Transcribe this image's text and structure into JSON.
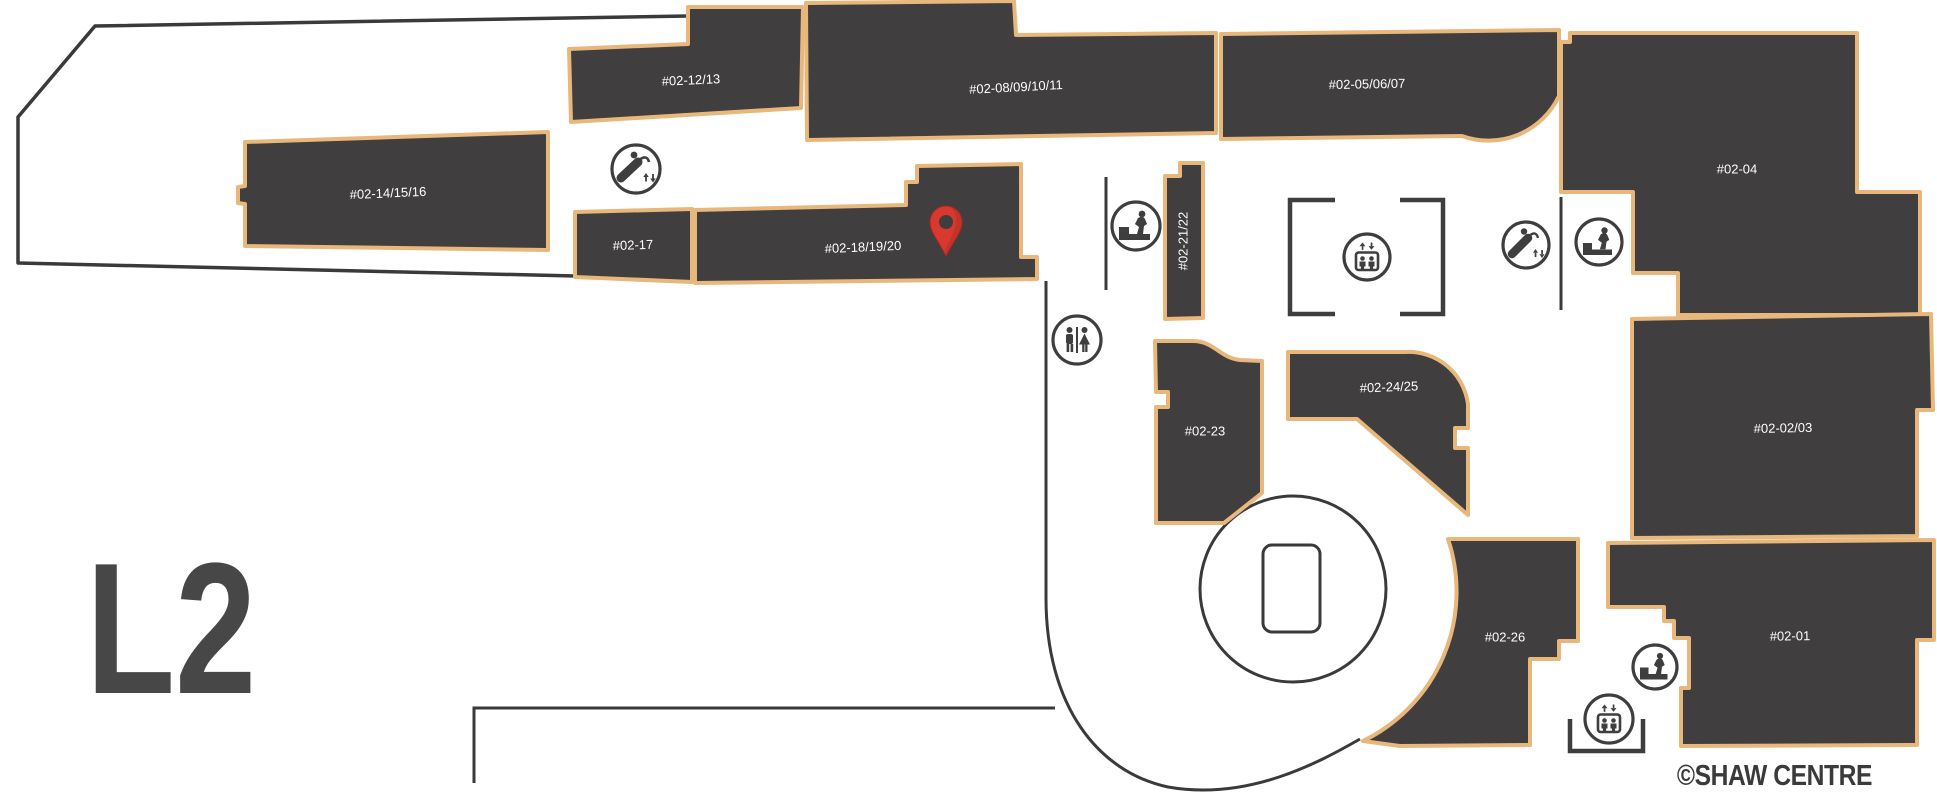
{
  "title": "Shaw Centre Floor Plan - Level 2",
  "floor_label": "L2",
  "copyright": "©SHAW CENTRE",
  "colors": {
    "background": "#FFFFFF",
    "unit_fill": "#403E3E",
    "unit_border": "#E8B77C",
    "outline": "#3A3A3A",
    "label_text": "#FFFFFF",
    "floor_text": "#474747",
    "pin_red": "#D8382E",
    "pin_red_dark": "#A5291F",
    "pin_hole": "#3F3E3E"
  },
  "units": [
    {
      "label": "#02-12/13"
    },
    {
      "label": "#02-08/09/10/11"
    },
    {
      "label": "#02-05/06/07"
    },
    {
      "label": "#02-04"
    },
    {
      "label": "#02-14/15/16"
    },
    {
      "label": "#02-17"
    },
    {
      "label": "#02-18/19/20"
    },
    {
      "label": "#02-21/22"
    },
    {
      "label": "#02-23"
    },
    {
      "label": "#02-24/25"
    },
    {
      "label": "#02-02/03"
    },
    {
      "label": "#02-26"
    },
    {
      "label": "#02-01"
    }
  ],
  "marker": {
    "type": "location-pin",
    "on_unit": "#02-18/19/20"
  },
  "icons": [
    {
      "type": "escalator",
      "area": "upper-left"
    },
    {
      "type": "stairs",
      "area": "center"
    },
    {
      "type": "elevator",
      "area": "center-lift-lobby"
    },
    {
      "type": "restroom",
      "area": "center"
    },
    {
      "type": "escalator",
      "area": "right"
    },
    {
      "type": "stairs",
      "area": "right"
    },
    {
      "type": "stairs",
      "area": "lower-right"
    },
    {
      "type": "elevator",
      "area": "lower-right"
    }
  ],
  "features": {
    "atrium": "circular void with lift shaft"
  }
}
